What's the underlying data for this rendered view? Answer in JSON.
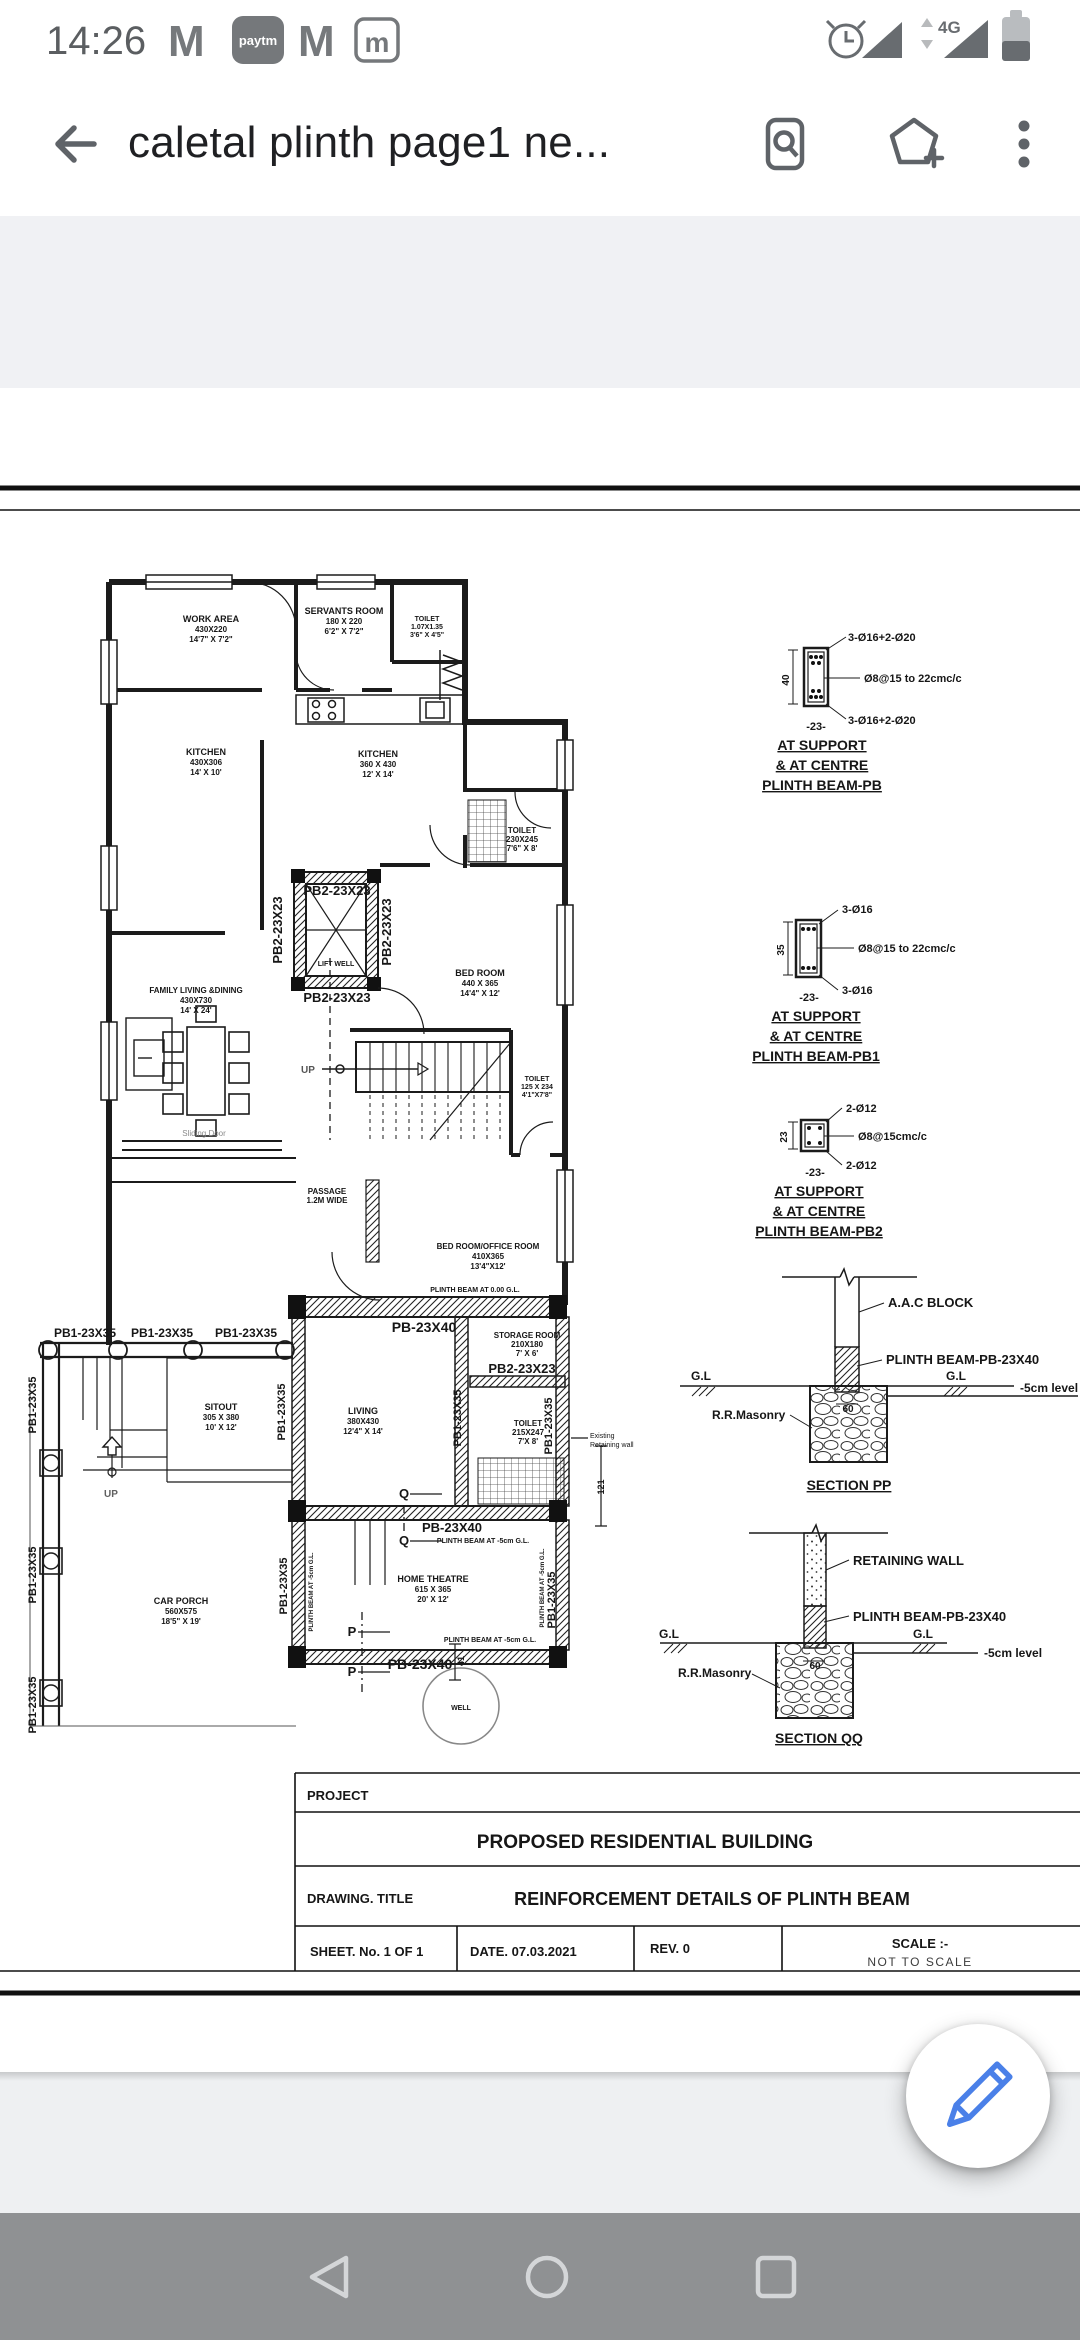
{
  "status_bar": {
    "time": "14:26",
    "gmail": "M",
    "paytm": "paytm",
    "mail_badge": "m",
    "network": "4G"
  },
  "app_bar": {
    "title": "caletal plinth page1 ne..."
  },
  "fab": {
    "icon": "pencil",
    "color": "#4a80e8"
  },
  "nav_bar": {
    "buttons": [
      "back",
      "home",
      "recents"
    ]
  },
  "colors": {
    "appbar_icon": "#5f6368",
    "status_icon": "#6b6f73",
    "nav_bg": "#8f9193",
    "viewer_bg": "#f0f1f4",
    "drawing_ink": "#1b1b1b",
    "fab_accent": "#4a80e8"
  },
  "drawing": {
    "labels": [
      {
        "t": "WORK AREA",
        "x": 211,
        "y": 622,
        "s": 9
      },
      {
        "t": "430X220",
        "x": 211,
        "y": 632,
        "s": 8
      },
      {
        "t": "14'7\" X 7'2\"",
        "x": 211,
        "y": 642,
        "s": 8
      },
      {
        "t": "SERVANTS ROOM",
        "x": 344,
        "y": 614,
        "s": 9
      },
      {
        "t": "180 X 220",
        "x": 344,
        "y": 624,
        "s": 8
      },
      {
        "t": "6'2\" X 7'2\"",
        "x": 344,
        "y": 634,
        "s": 8
      },
      {
        "t": "TOILET",
        "x": 427,
        "y": 621,
        "s": 7
      },
      {
        "t": "1.07X1.35",
        "x": 427,
        "y": 629,
        "s": 7
      },
      {
        "t": "3'6\" X 4'5\"",
        "x": 427,
        "y": 637,
        "s": 7
      },
      {
        "t": "KITCHEN",
        "x": 206,
        "y": 755,
        "s": 9
      },
      {
        "t": "430X306",
        "x": 206,
        "y": 765,
        "s": 8
      },
      {
        "t": "14' X 10'",
        "x": 206,
        "y": 775,
        "s": 8
      },
      {
        "t": "KITCHEN",
        "x": 378,
        "y": 757,
        "s": 9
      },
      {
        "t": "360 X 430",
        "x": 378,
        "y": 767,
        "s": 8
      },
      {
        "t": "12' X 14'",
        "x": 378,
        "y": 777,
        "s": 8
      },
      {
        "t": "TOILET",
        "x": 522,
        "y": 833,
        "s": 8
      },
      {
        "t": "230X245",
        "x": 522,
        "y": 842,
        "s": 8
      },
      {
        "t": "7'6\" X 8'",
        "x": 522,
        "y": 851,
        "s": 8
      },
      {
        "t": "BED ROOM",
        "x": 480,
        "y": 976,
        "s": 9
      },
      {
        "t": "440 X 365",
        "x": 480,
        "y": 986,
        "s": 8
      },
      {
        "t": "14'4\" X 12'",
        "x": 480,
        "y": 996,
        "s": 8
      },
      {
        "t": "TOILET",
        "x": 537,
        "y": 1081,
        "s": 7
      },
      {
        "t": "125 X 234",
        "x": 537,
        "y": 1089,
        "s": 7
      },
      {
        "t": "4'1\"X7'8\"",
        "x": 537,
        "y": 1097,
        "s": 7
      },
      {
        "t": "FAMILY LIVING &DINING",
        "x": 196,
        "y": 993,
        "s": 8
      },
      {
        "t": "430X730",
        "x": 196,
        "y": 1003,
        "s": 8
      },
      {
        "t": "14' X 24'",
        "x": 196,
        "y": 1013,
        "s": 8
      },
      {
        "t": "LIFT WELL",
        "x": 336,
        "y": 966,
        "s": 7
      },
      {
        "t": "UP",
        "x": 308,
        "y": 1073,
        "s": 10,
        "c": "#555555"
      },
      {
        "t": "Sliding Door",
        "x": 204,
        "y": 1136,
        "s": 8,
        "c": "#8a8a8a",
        "w": 0
      },
      {
        "t": "PASSAGE",
        "x": 327,
        "y": 1194,
        "s": 8
      },
      {
        "t": "1.2M WIDE",
        "x": 327,
        "y": 1203,
        "s": 8
      },
      {
        "t": "BED ROOM/OFFICE ROOM",
        "x": 488,
        "y": 1249,
        "s": 8
      },
      {
        "t": "410X365",
        "x": 488,
        "y": 1259,
        "s": 8
      },
      {
        "t": "13'4\"X12'",
        "x": 488,
        "y": 1269,
        "s": 8
      },
      {
        "t": "PLINTH BEAM AT 0.00 G.L.",
        "x": 475,
        "y": 1292,
        "s": 7
      },
      {
        "t": "PB-23X40",
        "x": 424,
        "y": 1332,
        "s": 14
      },
      {
        "t": "STORAGE ROOM",
        "x": 527,
        "y": 1338,
        "s": 8
      },
      {
        "t": "210X180",
        "x": 527,
        "y": 1347,
        "s": 8
      },
      {
        "t": "7' X 6'",
        "x": 527,
        "y": 1356,
        "s": 8
      },
      {
        "t": "PB2-23X23",
        "x": 522,
        "y": 1373,
        "s": 13
      },
      {
        "t": "TOILET",
        "x": 528,
        "y": 1426,
        "s": 8
      },
      {
        "t": "215X247",
        "x": 528,
        "y": 1435,
        "s": 8
      },
      {
        "t": "7'X 8'",
        "x": 528,
        "y": 1444,
        "s": 8
      },
      {
        "t": "Existing",
        "x": 590,
        "y": 1438,
        "s": 7,
        "a": "s",
        "w": 0
      },
      {
        "t": "Retaining wall",
        "x": 590,
        "y": 1447,
        "s": 7,
        "a": "s",
        "w": 0
      },
      {
        "t": "LIVING",
        "x": 363,
        "y": 1414,
        "s": 9
      },
      {
        "t": "380X430",
        "x": 363,
        "y": 1424,
        "s": 8
      },
      {
        "t": "12'4\" X 14'",
        "x": 363,
        "y": 1434,
        "s": 8
      },
      {
        "t": "SITOUT",
        "x": 221,
        "y": 1410,
        "s": 9
      },
      {
        "t": "305 X 380",
        "x": 221,
        "y": 1420,
        "s": 8
      },
      {
        "t": "10' X 12'",
        "x": 221,
        "y": 1430,
        "s": 8
      },
      {
        "t": "UP",
        "x": 111,
        "y": 1497,
        "s": 10,
        "c": "#606060"
      },
      {
        "t": "CAR PORCH",
        "x": 181,
        "y": 1604,
        "s": 9
      },
      {
        "t": "560X575",
        "x": 181,
        "y": 1614,
        "s": 8
      },
      {
        "t": "18'5\" X 19'",
        "x": 181,
        "y": 1624,
        "s": 8
      },
      {
        "t": "HOME THEATRE",
        "x": 433,
        "y": 1582,
        "s": 9
      },
      {
        "t": "615 X 365",
        "x": 433,
        "y": 1592,
        "s": 8
      },
      {
        "t": "20' X 12'",
        "x": 433,
        "y": 1602,
        "s": 8
      },
      {
        "t": "WELL",
        "x": 461,
        "y": 1710,
        "s": 7
      },
      {
        "t": "Q",
        "x": 404,
        "y": 1498,
        "s": 13
      },
      {
        "t": "Q",
        "x": 404,
        "y": 1545,
        "s": 13
      },
      {
        "t": "PB-23X40",
        "x": 452,
        "y": 1532,
        "s": 13
      },
      {
        "t": "PLINTH BEAM AT -5cm G.L.",
        "x": 483,
        "y": 1543,
        "s": 7
      },
      {
        "t": "PLINTH BEAM AT -5cm G.L.",
        "x": 490,
        "y": 1642,
        "s": 7
      },
      {
        "t": "PB-23X40",
        "x": 420,
        "y": 1669,
        "s": 14
      },
      {
        "t": "P",
        "x": 352,
        "y": 1636,
        "s": 13
      },
      {
        "t": "P",
        "x": 352,
        "y": 1676,
        "s": 13
      },
      {
        "t": "41",
        "x": 464,
        "y": 1661,
        "s": 9,
        "r": -90
      },
      {
        "t": "121",
        "x": 604,
        "y": 1487,
        "s": 9,
        "r": -90
      },
      {
        "t": "PB1-23X35",
        "x": 85,
        "y": 1337,
        "s": 12
      },
      {
        "t": "PB1-23X35",
        "x": 162,
        "y": 1337,
        "s": 12
      },
      {
        "t": "PB1-23X35",
        "x": 246,
        "y": 1337,
        "s": 12
      },
      {
        "t": "PB1-23X35",
        "x": 36,
        "y": 1405,
        "s": 11,
        "r": -90
      },
      {
        "t": "PB1-23X35",
        "x": 36,
        "y": 1575,
        "s": 11,
        "r": -90
      },
      {
        "t": "PB1-23X35",
        "x": 36,
        "y": 1705,
        "s": 11,
        "r": -90
      },
      {
        "t": "PB1-23X35",
        "x": 285,
        "y": 1412,
        "s": 11,
        "r": -90
      },
      {
        "t": "PB1-23X35",
        "x": 461,
        "y": 1418,
        "s": 11,
        "r": -90
      },
      {
        "t": "PB1-23X35",
        "x": 552,
        "y": 1426,
        "s": 11,
        "r": -90
      },
      {
        "t": "PB1-23X35",
        "x": 287,
        "y": 1586,
        "s": 11,
        "r": -90
      },
      {
        "t": "PB1-23X35",
        "x": 555,
        "y": 1600,
        "s": 11,
        "r": -90
      },
      {
        "t": "PLINTH BEAM AT -5cm G.L.",
        "x": 313,
        "y": 1592,
        "s": 6,
        "r": -90
      },
      {
        "t": "PLINTH BEAM AT -5cm G.L.",
        "x": 544,
        "y": 1588,
        "s": 6,
        "r": -90
      },
      {
        "t": "PB2-23X23",
        "x": 337,
        "y": 895,
        "s": 13
      },
      {
        "t": "PB2-23X23",
        "x": 337,
        "y": 1002,
        "s": 13
      },
      {
        "t": "PB2-23X23",
        "x": 282,
        "y": 930,
        "s": 13,
        "r": -90
      },
      {
        "t": "PB2-23X23",
        "x": 391,
        "y": 932,
        "s": 13,
        "r": -90
      },
      {
        "t": "3-Ø16+2-Ø20",
        "x": 848,
        "y": 641,
        "s": 11,
        "a": "s"
      },
      {
        "t": "Ø8@15 to 22cmc/c",
        "x": 864,
        "y": 682,
        "s": 11,
        "a": "s"
      },
      {
        "t": "3-Ø16+2-Ø20",
        "x": 848,
        "y": 724,
        "s": 11,
        "a": "s"
      },
      {
        "t": "40",
        "x": 789,
        "y": 680,
        "s": 10,
        "r": -90
      },
      {
        "t": "-23-",
        "x": 816,
        "y": 730,
        "s": 11
      },
      {
        "t": "AT SUPPORT",
        "x": 822,
        "y": 750,
        "s": 14,
        "u": 1
      },
      {
        "t": "& AT CENTRE",
        "x": 822,
        "y": 770,
        "s": 14,
        "u": 1
      },
      {
        "t": "PLINTH BEAM-PB",
        "x": 822,
        "y": 790,
        "s": 14,
        "u": 1
      },
      {
        "t": "3-Ø16",
        "x": 842,
        "y": 913,
        "s": 11,
        "a": "s"
      },
      {
        "t": "Ø8@15 to 22cmc/c",
        "x": 858,
        "y": 952,
        "s": 11,
        "a": "s"
      },
      {
        "t": "3-Ø16",
        "x": 842,
        "y": 994,
        "s": 11,
        "a": "s"
      },
      {
        "t": "35",
        "x": 784,
        "y": 950,
        "s": 10,
        "r": -90
      },
      {
        "t": "-23-",
        "x": 809,
        "y": 1001,
        "s": 11
      },
      {
        "t": "AT SUPPORT",
        "x": 816,
        "y": 1021,
        "s": 14,
        "u": 1
      },
      {
        "t": "& AT CENTRE",
        "x": 816,
        "y": 1041,
        "s": 14,
        "u": 1
      },
      {
        "t": "PLINTH BEAM-PB1",
        "x": 816,
        "y": 1061,
        "s": 14,
        "u": 1
      },
      {
        "t": "2-Ø12",
        "x": 846,
        "y": 1112,
        "s": 11,
        "a": "s"
      },
      {
        "t": "Ø8@15cmc/c",
        "x": 858,
        "y": 1140,
        "s": 11,
        "a": "s"
      },
      {
        "t": "2-Ø12",
        "x": 846,
        "y": 1169,
        "s": 11,
        "a": "s"
      },
      {
        "t": "23",
        "x": 787,
        "y": 1137,
        "s": 10,
        "r": -90
      },
      {
        "t": "-23-",
        "x": 815,
        "y": 1176,
        "s": 11
      },
      {
        "t": "AT SUPPORT",
        "x": 819,
        "y": 1196,
        "s": 14,
        "u": 1
      },
      {
        "t": "& AT CENTRE",
        "x": 819,
        "y": 1216,
        "s": 14,
        "u": 1
      },
      {
        "t": "PLINTH BEAM-PB2",
        "x": 819,
        "y": 1236,
        "s": 14,
        "u": 1
      },
      {
        "t": "A.A.C BLOCK",
        "x": 888,
        "y": 1307,
        "s": 13,
        "a": "s"
      },
      {
        "t": "PLINTH BEAM-PB-23X40",
        "x": 886,
        "y": 1364,
        "s": 13,
        "a": "s"
      },
      {
        "t": "G.L",
        "x": 701,
        "y": 1380,
        "s": 12
      },
      {
        "t": "G.L",
        "x": 956,
        "y": 1380,
        "s": 12
      },
      {
        "t": "-5cm level",
        "x": 1020,
        "y": 1392,
        "s": 12,
        "a": "s"
      },
      {
        "t": "R.R.Masonry",
        "x": 712,
        "y": 1419,
        "s": 12,
        "a": "s"
      },
      {
        "t": "60",
        "x": 848,
        "y": 1412,
        "s": 10
      },
      {
        "t": "SECTION PP",
        "x": 849,
        "y": 1490,
        "s": 14,
        "u": 1
      },
      {
        "t": "RETAINING WALL",
        "x": 853,
        "y": 1565,
        "s": 13,
        "a": "s"
      },
      {
        "t": "PLINTH BEAM-PB-23X40",
        "x": 853,
        "y": 1621,
        "s": 13,
        "a": "s"
      },
      {
        "t": "G.L",
        "x": 669,
        "y": 1638,
        "s": 12
      },
      {
        "t": "G.L",
        "x": 923,
        "y": 1638,
        "s": 12
      },
      {
        "t": "-5cm level",
        "x": 984,
        "y": 1657,
        "s": 12,
        "a": "s"
      },
      {
        "t": "R.R.Masonry",
        "x": 678,
        "y": 1677,
        "s": 12,
        "a": "s"
      },
      {
        "t": "60",
        "x": 815,
        "y": 1669,
        "s": 10
      },
      {
        "t": "SECTION QQ",
        "x": 819,
        "y": 1743,
        "s": 14,
        "u": 1
      },
      {
        "t": "PROJECT",
        "x": 307,
        "y": 1800,
        "s": 13,
        "a": "s",
        "f": "serif"
      },
      {
        "t": "PROPOSED RESIDENTIAL BUILDING",
        "x": 645,
        "y": 1848,
        "s": 19,
        "f": "serif"
      },
      {
        "t": "DRAWING. TITLE",
        "x": 307,
        "y": 1903,
        "s": 13,
        "a": "s",
        "f": "serif"
      },
      {
        "t": "REINFORCEMENT DETAILS OF PLINTH BEAM",
        "x": 712,
        "y": 1905,
        "s": 18,
        "f": "serif"
      },
      {
        "t": "SHEET. No. 1 OF 1",
        "x": 310,
        "y": 1956,
        "s": 13,
        "a": "s",
        "f": "serif"
      },
      {
        "t": "DATE. 07.03.2021",
        "x": 470,
        "y": 1956,
        "s": 13,
        "a": "s",
        "f": "serif"
      },
      {
        "t": "REV. 0",
        "x": 650,
        "y": 1953,
        "s": 13,
        "a": "s",
        "f": "serif"
      },
      {
        "t": "SCALE :-",
        "x": 920,
        "y": 1948,
        "s": 13,
        "f": "serif"
      },
      {
        "t": "NOT TO SCALE",
        "x": 920,
        "y": 1966,
        "s": 12,
        "w": 0,
        "c": "#3c3c3c",
        "ls": 1.5
      }
    ]
  }
}
